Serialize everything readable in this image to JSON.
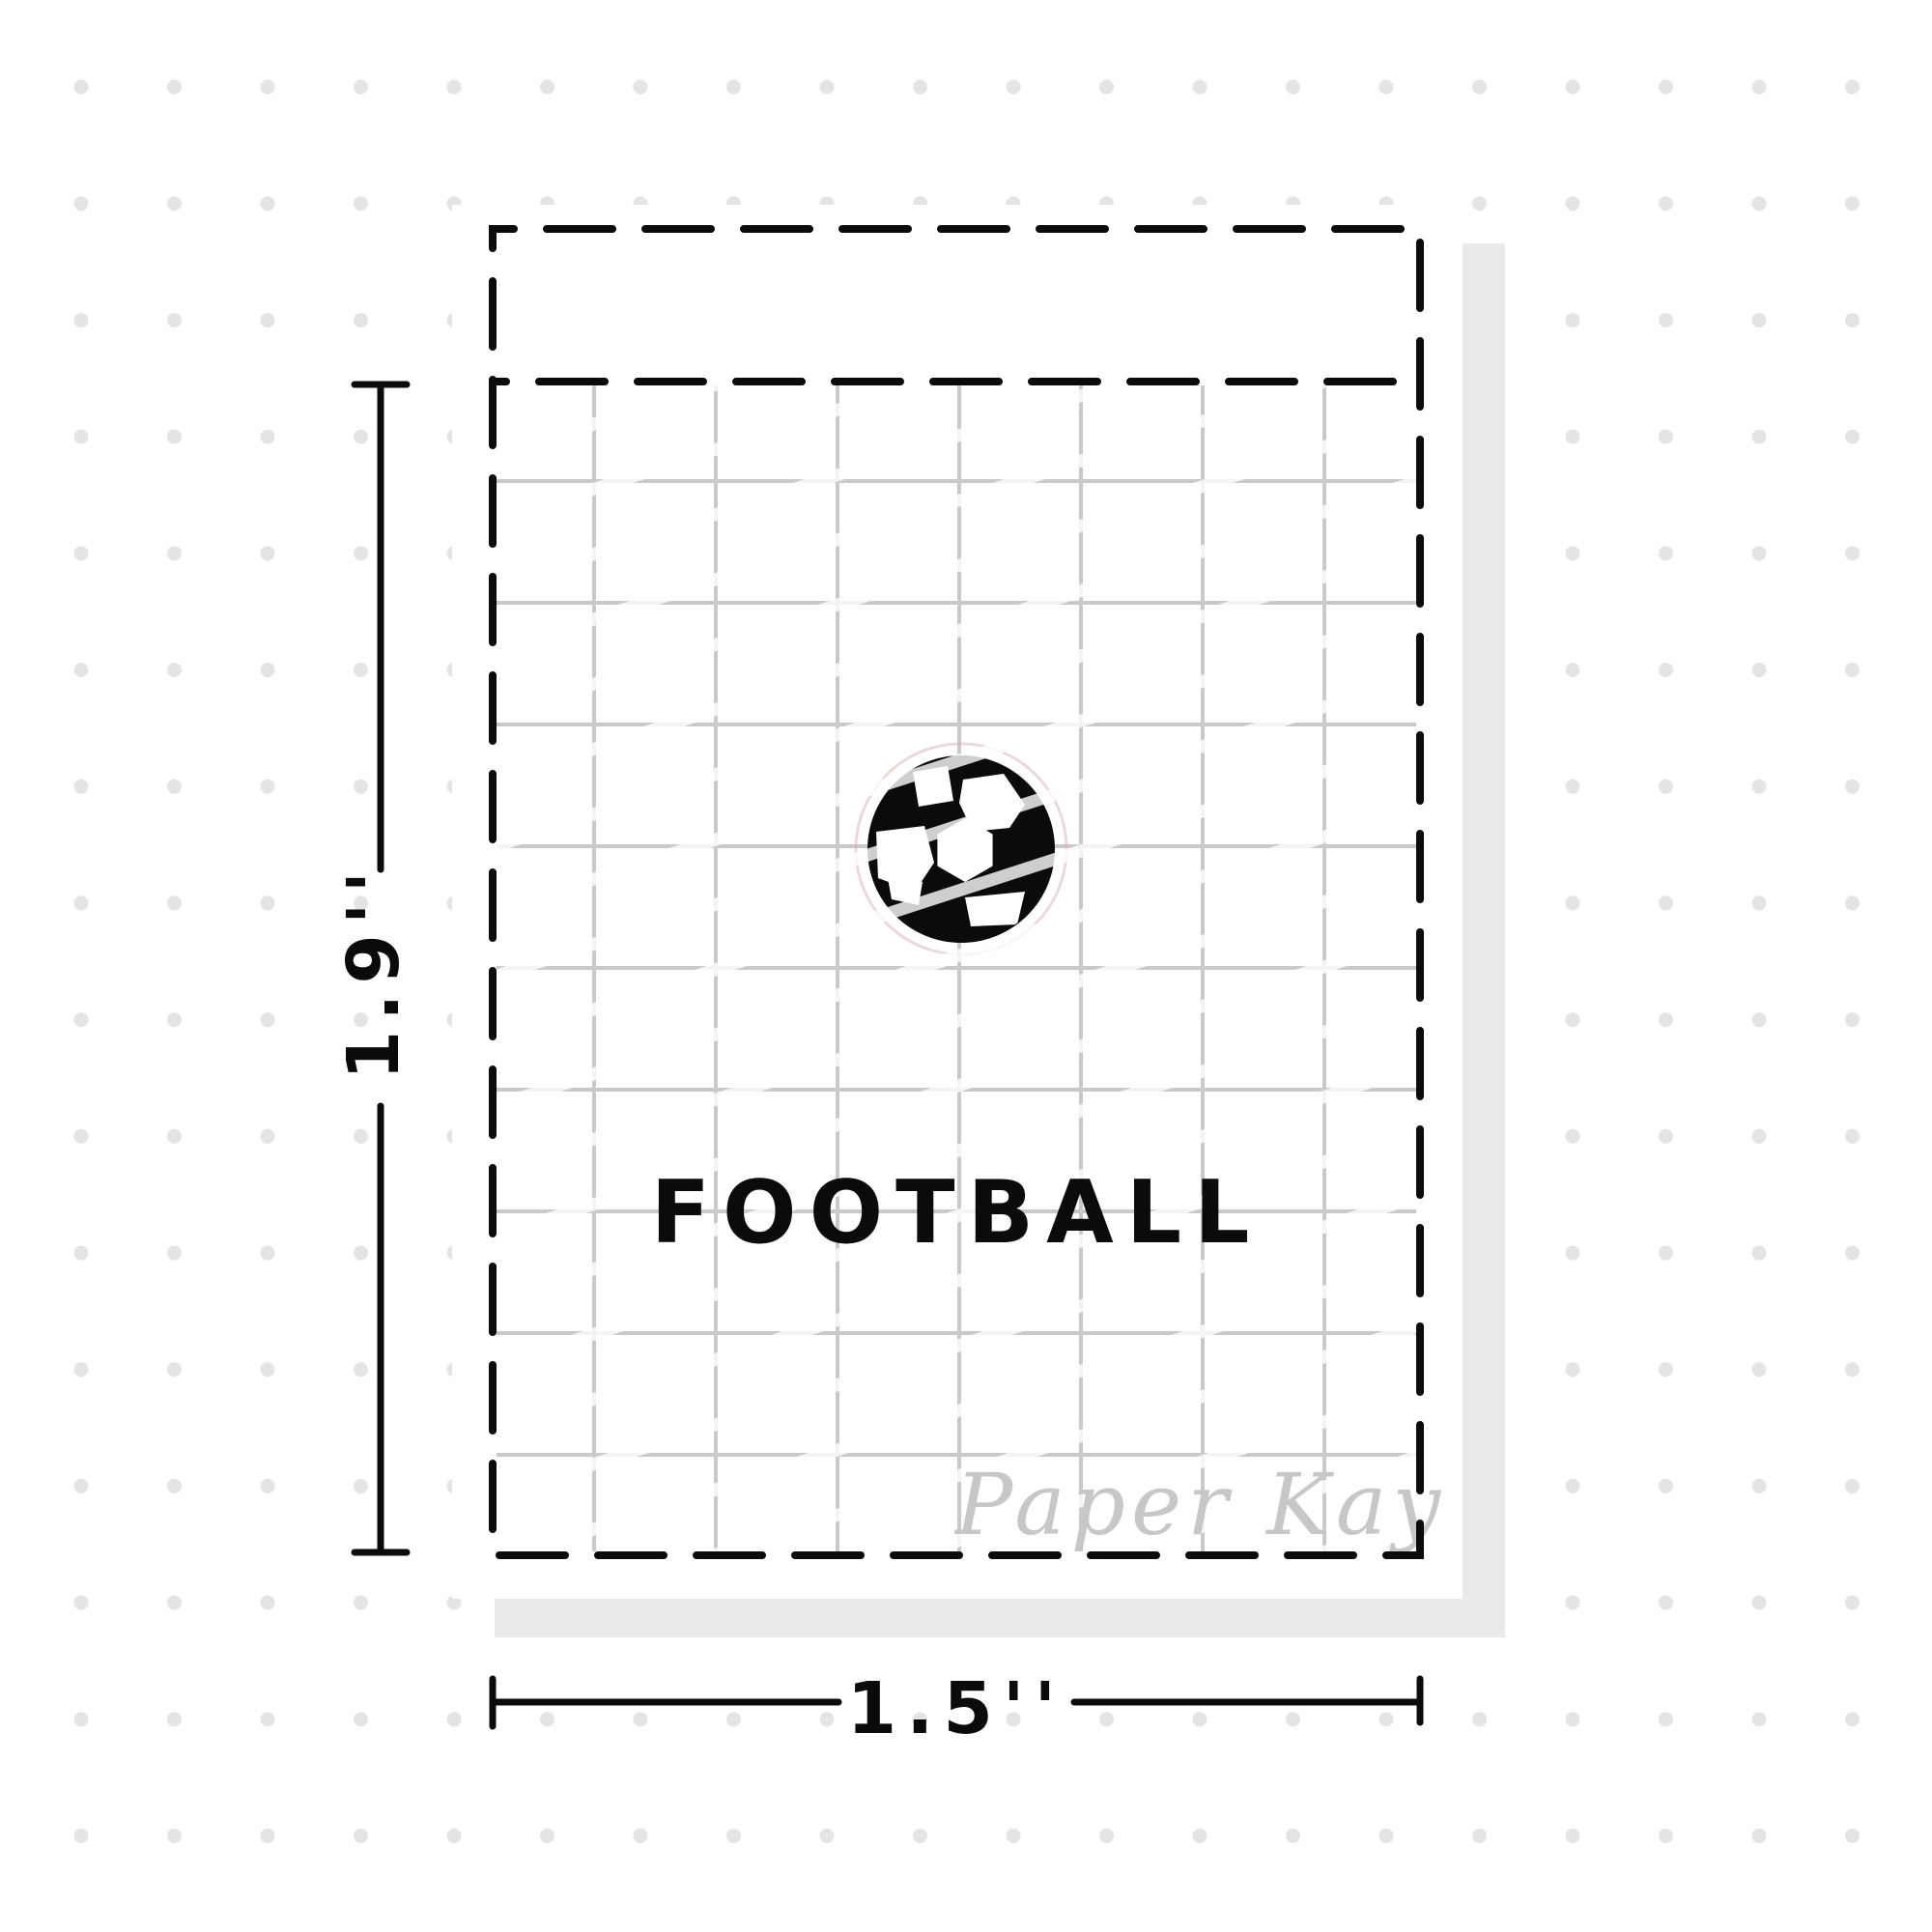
{
  "artwork": {
    "sticker_label": "FOOTBALL",
    "icon": "soccer-ball",
    "height_dimension": "1.9''",
    "width_dimension": "1.5''",
    "watermark": "Paper Kay"
  },
  "colors": {
    "background": "#ffffff",
    "ink": "#0b0b0b",
    "grid_line": "#c9c9c9",
    "dot": "#e4e4e4",
    "shadow": "#eaeaea",
    "watermark": "#c7c7c7",
    "cut_line": "#d8b4b4",
    "stripe": "#ffffff"
  }
}
